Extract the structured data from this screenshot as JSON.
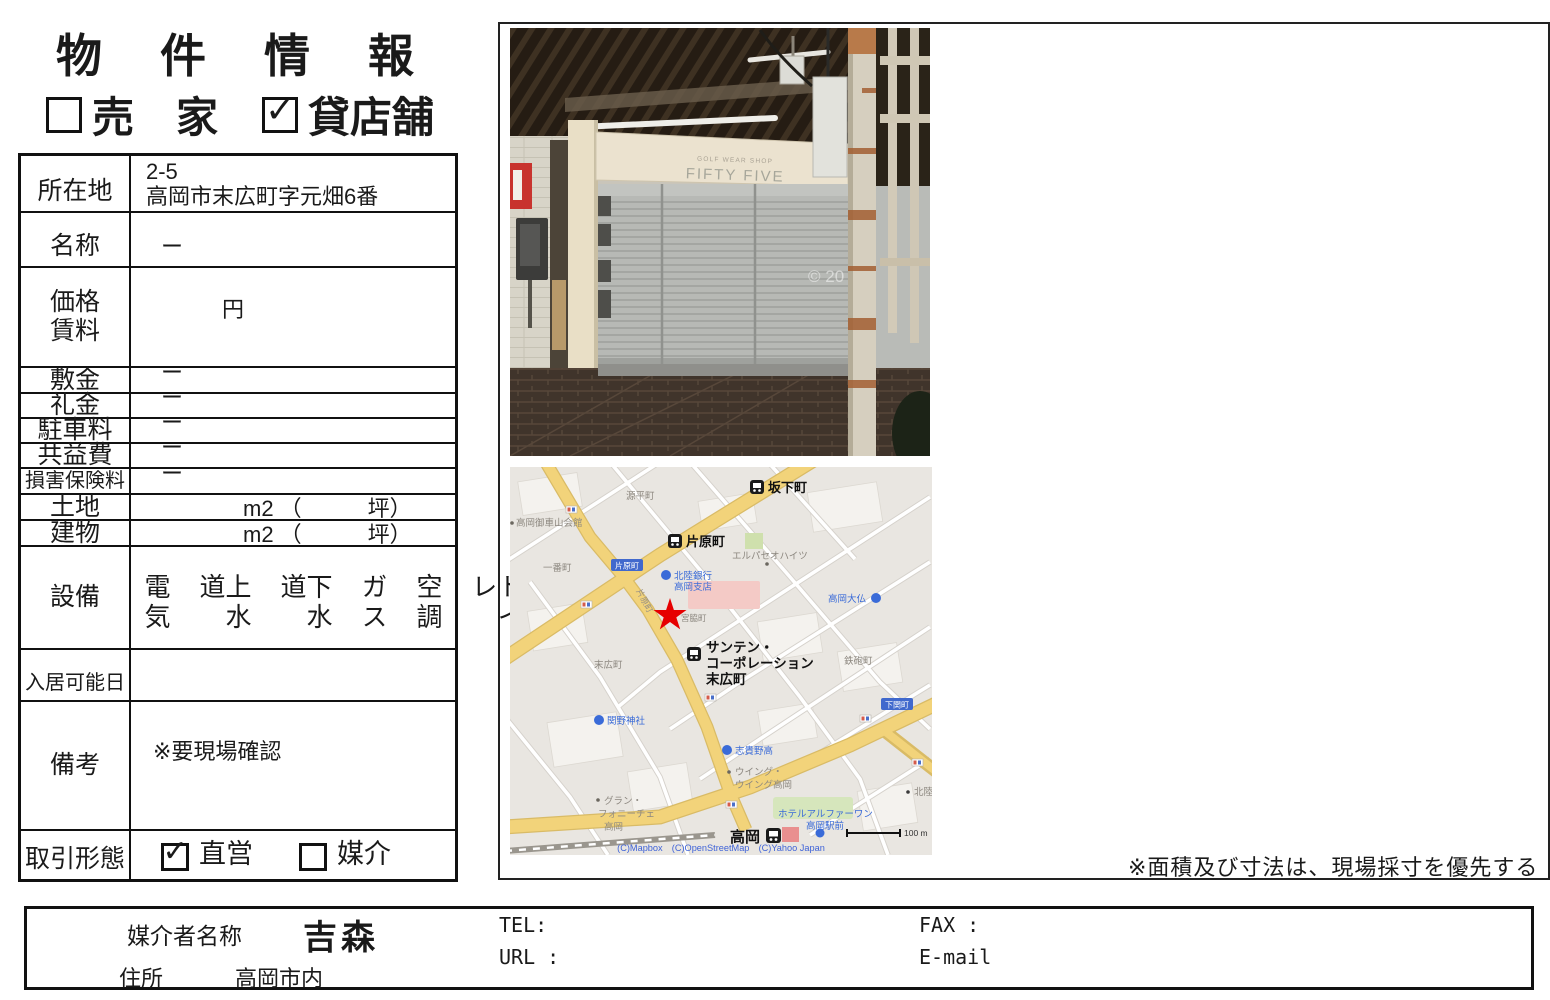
{
  "page": {
    "title": "物　件　情　報",
    "check_glyph": "✓",
    "property_types": {
      "sale": {
        "label": "売　家",
        "checked": false
      },
      "rent": {
        "label": "貸店舗",
        "checked": true
      }
    },
    "note": "※面積及び寸法は、現場採寸を優先する"
  },
  "table": {
    "location": {
      "label": "所在地",
      "line1": "2-5",
      "line2": "高岡市末広町字元畑6番"
    },
    "name": {
      "label": "名称",
      "value": "ー"
    },
    "price": {
      "label_line1": "価格",
      "label_line2": "賃料",
      "value": "円"
    },
    "deposit": {
      "label": "敷金",
      "value": "ー"
    },
    "key_money": {
      "label": "礼金",
      "value": "ー"
    },
    "parking": {
      "label": "駐車料",
      "value": "ー"
    },
    "common_fee": {
      "label": "共益費",
      "value": "ー"
    },
    "insurance": {
      "label": "損害保険料",
      "value": "ー"
    },
    "land": {
      "label": "土地",
      "unit": "m2 （　　　坪）"
    },
    "building": {
      "label": "建物",
      "unit": "m2 （　　　坪）"
    },
    "facilities": {
      "label": "設備",
      "items": [
        "電気",
        "上水道",
        "下水道",
        "ガス",
        "空調",
        "トイレ"
      ]
    },
    "move_in": {
      "label": "入居可能日",
      "value": ""
    },
    "remarks": {
      "label": "備考",
      "value": "※要現場確認"
    },
    "transaction": {
      "label": "取引形態",
      "direct": {
        "label": "直営",
        "checked": true
      },
      "agency": {
        "label": "媒介",
        "checked": false
      }
    }
  },
  "photo": {
    "sign_sub": "GOLF WEAR SHOP",
    "sign_main": "FIFTY FIVE",
    "watermark": "© 20"
  },
  "map": {
    "colors": {
      "road_yellow": "#f2d37a",
      "star_red": "#e60000",
      "badge_blue": "#4169cd",
      "poi_blue": "#3a6bd8",
      "attribution_blue": "#3f63d8"
    },
    "labels": {
      "sakashitamachi": "坂下町",
      "genpeimachi": "源平町",
      "mikurumayama_hall": "高岡御車山会館",
      "kataharamachi_station": "片原町",
      "kataharamachi_badge": "片原町",
      "kataharamachi_road": "片原町",
      "ichibancho": "一番町",
      "hokuriku_bank1": "北陸銀行",
      "hokuriku_bank2": "高岡支店",
      "elpaseo": "エルパセオハイツ",
      "daibutsu": "高岡大仏",
      "miyawakicho": "宮脇町",
      "santen1": "サンテン・",
      "santen2": "コーポレーション",
      "santen3": "末広町",
      "suehiromachi": "末広町",
      "teppomachi": "鉄砲町",
      "sekino_shrine": "関野神社",
      "shimozekimachi_badge": "下関町",
      "shikino_high": "志貴野高",
      "wing1": "ウイング・",
      "wing2": "ウイング高岡",
      "gran1": "グラン・",
      "gran2": "フォニーチェ",
      "gran3": "高岡",
      "hotel1": "ホテルアルファーワン",
      "hotel2": "高岡駅前",
      "takaoka_station": "高岡",
      "hokuriku_partial": "北陸",
      "scale": "100 m",
      "attribution": "(C)Mapbox　(C)OpenStreetMap　(C)Yahoo Japan"
    }
  },
  "footer": {
    "agent_label": "媒介者名称",
    "agent_name": "吉森",
    "tel_label": "TEL:",
    "url_label": "URL :",
    "fax_label": "FAX :",
    "email_label": "E-mail",
    "address_label": "住所",
    "address_value": "高岡市内"
  }
}
